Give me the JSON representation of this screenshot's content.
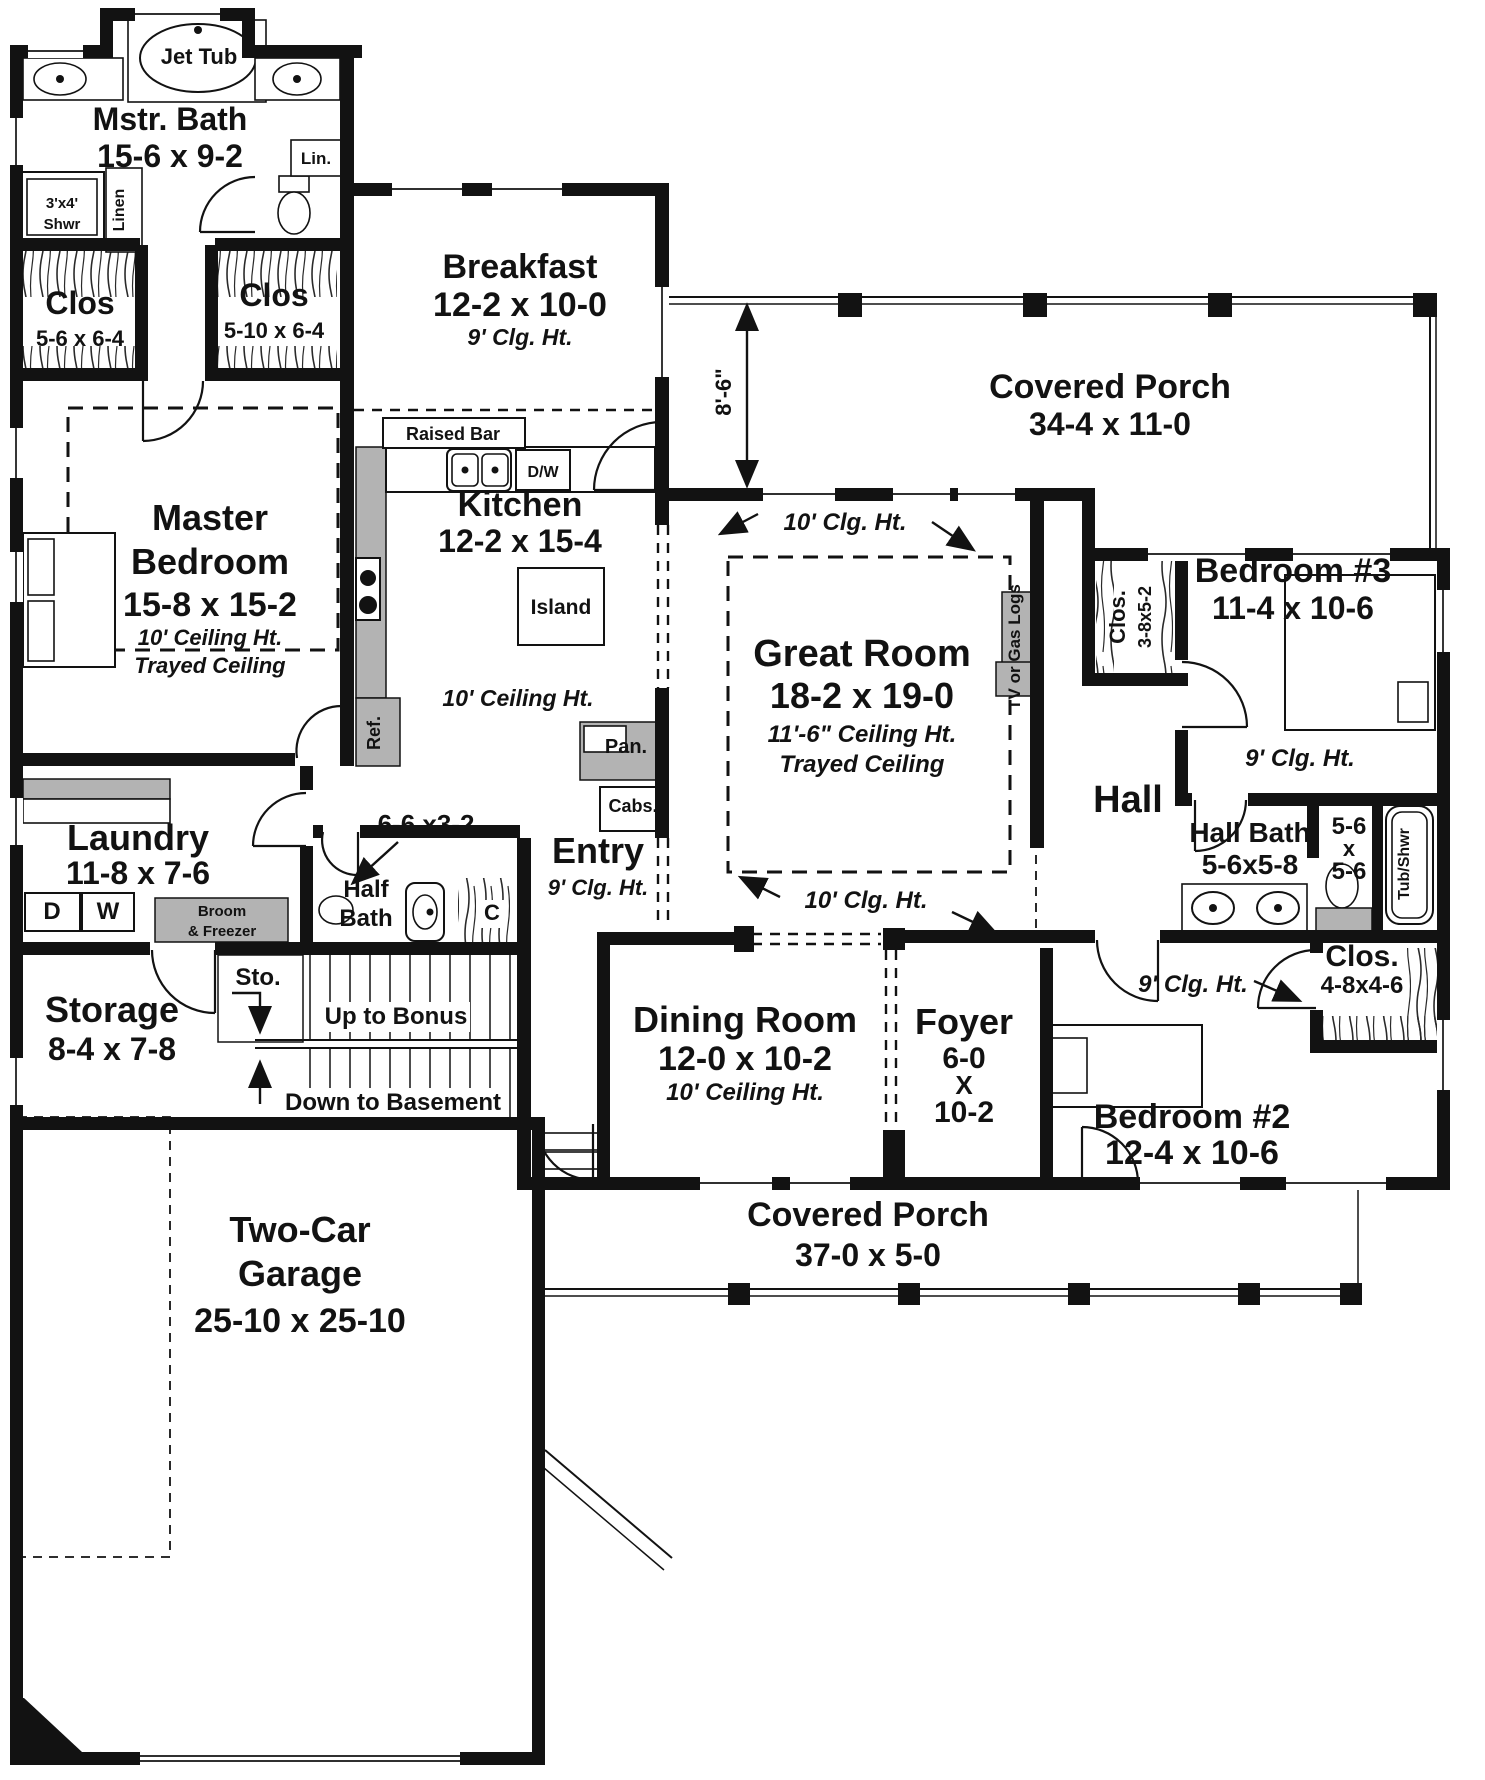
{
  "colors": {
    "wall": "#121212",
    "cabinet_gray": "#b3b3b3",
    "background": "#ffffff"
  },
  "floorplan": {
    "type": "single-story-house-first-floor",
    "labels": [
      {
        "id": "jet-tub",
        "x": 199,
        "y": 64,
        "lines": [
          {
            "t": "Jet Tub",
            "s": 22
          }
        ]
      },
      {
        "id": "master-bath",
        "x": 170,
        "y": 130,
        "lines": [
          {
            "t": "Mstr. Bath",
            "s": 32
          },
          {
            "t": "15-6 x 9-2",
            "s": 32,
            "dy": 37
          }
        ]
      },
      {
        "id": "linen-cabinet",
        "x": 316,
        "y": 164,
        "lines": [
          {
            "t": "Lin.",
            "s": 17
          }
        ]
      },
      {
        "id": "shower",
        "x": 62,
        "y": 208,
        "lines": [
          {
            "t": "3'x4'",
            "s": 15
          },
          {
            "t": "Shwr",
            "s": 15,
            "dy": 21
          }
        ]
      },
      {
        "id": "linen-closet",
        "x": 124,
        "y": 210,
        "rot": -90,
        "lines": [
          {
            "t": "Linen",
            "s": 16
          }
        ]
      },
      {
        "id": "master-closet-1",
        "x": 80,
        "y": 314,
        "lines": [
          {
            "t": "Clos",
            "s": 32
          },
          {
            "t": "5-6 x 6-4",
            "s": 22,
            "dy": 32
          }
        ]
      },
      {
        "id": "master-closet-2",
        "x": 274,
        "y": 306,
        "lines": [
          {
            "t": "Clos",
            "s": 32
          },
          {
            "t": "5-10 x 6-4",
            "s": 22,
            "dy": 32
          }
        ]
      },
      {
        "id": "master-bedroom",
        "x": 210,
        "y": 530,
        "lines": [
          {
            "t": "Master",
            "s": 36
          },
          {
            "t": "Bedroom",
            "s": 36,
            "dy": 44
          },
          {
            "t": "15-8 x 15-2",
            "s": 34,
            "dy": 86
          },
          {
            "t": "10' Ceiling Ht.",
            "s": 22,
            "i": true,
            "dy": 115
          },
          {
            "t": "Trayed Ceiling",
            "s": 22,
            "i": true,
            "dy": 143
          }
        ]
      },
      {
        "id": "breakfast",
        "x": 520,
        "y": 278,
        "lines": [
          {
            "t": "Breakfast",
            "s": 34
          },
          {
            "t": "12-2 x 10-0",
            "s": 34,
            "dy": 38
          },
          {
            "t": "9' Clg. Ht.",
            "s": 23,
            "i": true,
            "dy": 67
          }
        ]
      },
      {
        "id": "raised-bar",
        "x": 453,
        "y": 440,
        "lines": [
          {
            "t": "Raised Bar",
            "s": 18
          }
        ]
      },
      {
        "id": "dishwasher",
        "x": 543,
        "y": 477,
        "lines": [
          {
            "t": "D/W",
            "s": 16
          }
        ]
      },
      {
        "id": "kitchen",
        "x": 520,
        "y": 516,
        "lines": [
          {
            "t": "Kitchen",
            "s": 34
          },
          {
            "t": "12-2 x 15-4",
            "s": 32,
            "dy": 36
          }
        ]
      },
      {
        "id": "island",
        "x": 561,
        "y": 614,
        "lines": [
          {
            "t": "Island",
            "s": 21
          }
        ]
      },
      {
        "id": "kitchen-ceiling",
        "x": 518,
        "y": 706,
        "lines": [
          {
            "t": "10' Ceiling Ht.",
            "s": 23,
            "i": true
          }
        ]
      },
      {
        "id": "refrigerator",
        "x": 380,
        "y": 733,
        "rot": -90,
        "lines": [
          {
            "t": "Ref.",
            "s": 18
          }
        ]
      },
      {
        "id": "pantry",
        "x": 626,
        "y": 753,
        "lines": [
          {
            "t": "Pan.",
            "s": 20
          }
        ]
      },
      {
        "id": "cabinets",
        "x": 633,
        "y": 812,
        "lines": [
          {
            "t": "Cabs.",
            "s": 18
          }
        ]
      },
      {
        "id": "covered-porch-top",
        "x": 1110,
        "y": 398,
        "lines": [
          {
            "t": "Covered Porch",
            "s": 34
          },
          {
            "t": "34-4 x 11-0",
            "s": 32,
            "dy": 37
          }
        ]
      },
      {
        "id": "porch-depth-dim",
        "x": 731,
        "y": 392,
        "rot": -90,
        "lines": [
          {
            "t": "8'-6\"",
            "s": 22
          }
        ]
      },
      {
        "id": "great-ceiling-top",
        "x": 845,
        "y": 530,
        "lines": [
          {
            "t": "10' Clg. Ht.",
            "s": 24,
            "i": true
          }
        ]
      },
      {
        "id": "great-room",
        "x": 862,
        "y": 666,
        "lines": [
          {
            "t": "Great Room",
            "s": 38
          },
          {
            "t": "18-2 x 19-0",
            "s": 36,
            "dy": 42
          },
          {
            "t": "11'-6\" Ceiling Ht.",
            "s": 24,
            "i": true,
            "dy": 76
          },
          {
            "t": "Trayed Ceiling",
            "s": 24,
            "i": true,
            "dy": 106
          }
        ]
      },
      {
        "id": "tv-gas-logs",
        "x": 1020,
        "y": 647,
        "rot": -90,
        "lines": [
          {
            "t": "TV or Gas Logs",
            "s": 17
          }
        ]
      },
      {
        "id": "closet-3-8-name",
        "x": 1125,
        "y": 617,
        "rot": -90,
        "lines": [
          {
            "t": "Clos.",
            "s": 22
          }
        ]
      },
      {
        "id": "closet-3-8-dim",
        "x": 1151,
        "y": 617,
        "rot": -90,
        "lines": [
          {
            "t": "3-8x5-2",
            "s": 18
          }
        ]
      },
      {
        "id": "bedroom-3",
        "x": 1293,
        "y": 582,
        "lines": [
          {
            "t": "Bedroom #3",
            "s": 34
          },
          {
            "t": "11-4 x 10-6",
            "s": 32,
            "dy": 37
          }
        ]
      },
      {
        "id": "bedroom3-ceiling",
        "x": 1300,
        "y": 766,
        "lines": [
          {
            "t": "9' Clg. Ht.",
            "s": 24,
            "i": true
          }
        ]
      },
      {
        "id": "hall",
        "x": 1128,
        "y": 812,
        "lines": [
          {
            "t": "Hall",
            "s": 38
          }
        ]
      },
      {
        "id": "hall-bath",
        "x": 1250,
        "y": 842,
        "lines": [
          {
            "t": "Hall Bath",
            "s": 28
          },
          {
            "t": "5-6x5-8",
            "s": 28,
            "dy": 32
          }
        ]
      },
      {
        "id": "wc-dim",
        "x": 1349,
        "y": 834,
        "lines": [
          {
            "t": "5-6",
            "s": 24
          },
          {
            "t": "x",
            "s": 22,
            "dy": 22
          },
          {
            "t": "5-6",
            "s": 24,
            "dy": 45
          }
        ]
      },
      {
        "id": "tub-shower",
        "x": 1409,
        "y": 864,
        "rot": -90,
        "lines": [
          {
            "t": "Tub/Shwr",
            "s": 16
          }
        ]
      },
      {
        "id": "great-ceiling-bottom",
        "x": 866,
        "y": 908,
        "lines": [
          {
            "t": "10' Clg. Ht.",
            "s": 24,
            "i": true
          }
        ]
      },
      {
        "id": "laundry",
        "x": 138,
        "y": 850,
        "lines": [
          {
            "t": "Laundry",
            "s": 36
          },
          {
            "t": "11-8 x 7-6",
            "s": 32,
            "dy": 34
          }
        ]
      },
      {
        "id": "dryer",
        "x": 52,
        "y": 919,
        "lines": [
          {
            "t": "D",
            "s": 24
          }
        ]
      },
      {
        "id": "washer",
        "x": 108,
        "y": 919,
        "lines": [
          {
            "t": "W",
            "s": 24
          }
        ]
      },
      {
        "id": "broom-freezer",
        "x": 222,
        "y": 916,
        "lines": [
          {
            "t": "Broom",
            "s": 15
          },
          {
            "t": "& Freezer",
            "s": 15,
            "dy": 20
          }
        ]
      },
      {
        "id": "hall-dim",
        "x": 426,
        "y": 833,
        "lines": [
          {
            "t": "6-6 x3-2",
            "s": 26
          }
        ]
      },
      {
        "id": "half-bath",
        "x": 366,
        "y": 897,
        "lines": [
          {
            "t": "Half",
            "s": 24
          },
          {
            "t": "Bath",
            "s": 24,
            "dy": 29
          }
        ]
      },
      {
        "id": "coat-closet",
        "x": 492,
        "y": 920,
        "lines": [
          {
            "t": "C",
            "s": 22
          }
        ]
      },
      {
        "id": "entry",
        "x": 598,
        "y": 863,
        "lines": [
          {
            "t": "Entry",
            "s": 36
          },
          {
            "t": "9' Clg. Ht.",
            "s": 22,
            "i": true,
            "dy": 32
          }
        ]
      },
      {
        "id": "storage-under-stair",
        "x": 258,
        "y": 985,
        "lines": [
          {
            "t": "Sto.",
            "s": 24
          }
        ]
      },
      {
        "id": "up-to-bonus",
        "x": 396,
        "y": 1024,
        "lines": [
          {
            "t": "Up to Bonus",
            "s": 24
          }
        ]
      },
      {
        "id": "down-to-basement",
        "x": 393,
        "y": 1110,
        "lines": [
          {
            "t": "Down to Basement",
            "s": 24
          }
        ]
      },
      {
        "id": "storage",
        "x": 112,
        "y": 1022,
        "lines": [
          {
            "t": "Storage",
            "s": 36
          },
          {
            "t": "8-4 x 7-8",
            "s": 32,
            "dy": 38
          }
        ]
      },
      {
        "id": "dining-room",
        "x": 745,
        "y": 1032,
        "lines": [
          {
            "t": "Dining Room",
            "s": 36
          },
          {
            "t": "12-0 x 10-2",
            "s": 34,
            "dy": 38
          },
          {
            "t": "10' Ceiling Ht.",
            "s": 24,
            "i": true,
            "dy": 68
          }
        ]
      },
      {
        "id": "foyer",
        "x": 964,
        "y": 1034,
        "lines": [
          {
            "t": "Foyer",
            "s": 36
          },
          {
            "t": "6-0",
            "s": 30,
            "dy": 34
          },
          {
            "t": "X",
            "s": 26,
            "dy": 60
          },
          {
            "t": "10-2",
            "s": 30,
            "dy": 88
          }
        ]
      },
      {
        "id": "bedroom2-ceiling",
        "x": 1193,
        "y": 992,
        "lines": [
          {
            "t": "9' Clg. Ht.",
            "s": 24,
            "i": true
          }
        ]
      },
      {
        "id": "closet-4-8",
        "x": 1362,
        "y": 966,
        "lines": [
          {
            "t": "Clos.",
            "s": 30
          },
          {
            "t": "4-8x4-6",
            "s": 24,
            "dy": 27
          }
        ]
      },
      {
        "id": "bedroom-2",
        "x": 1192,
        "y": 1128,
        "lines": [
          {
            "t": "Bedroom #2",
            "s": 34
          },
          {
            "t": "12-4 x 10-6",
            "s": 34,
            "dy": 36
          }
        ]
      },
      {
        "id": "covered-porch-bottom",
        "x": 868,
        "y": 1226,
        "lines": [
          {
            "t": "Covered Porch",
            "s": 34
          },
          {
            "t": "37-0 x 5-0",
            "s": 32,
            "dy": 40
          }
        ]
      },
      {
        "id": "garage",
        "x": 300,
        "y": 1242,
        "lines": [
          {
            "t": "Two-Car",
            "s": 36
          },
          {
            "t": "Garage",
            "s": 36,
            "dy": 44
          },
          {
            "t": "25-10 x 25-10",
            "s": 34,
            "dy": 90
          }
        ]
      }
    ]
  }
}
